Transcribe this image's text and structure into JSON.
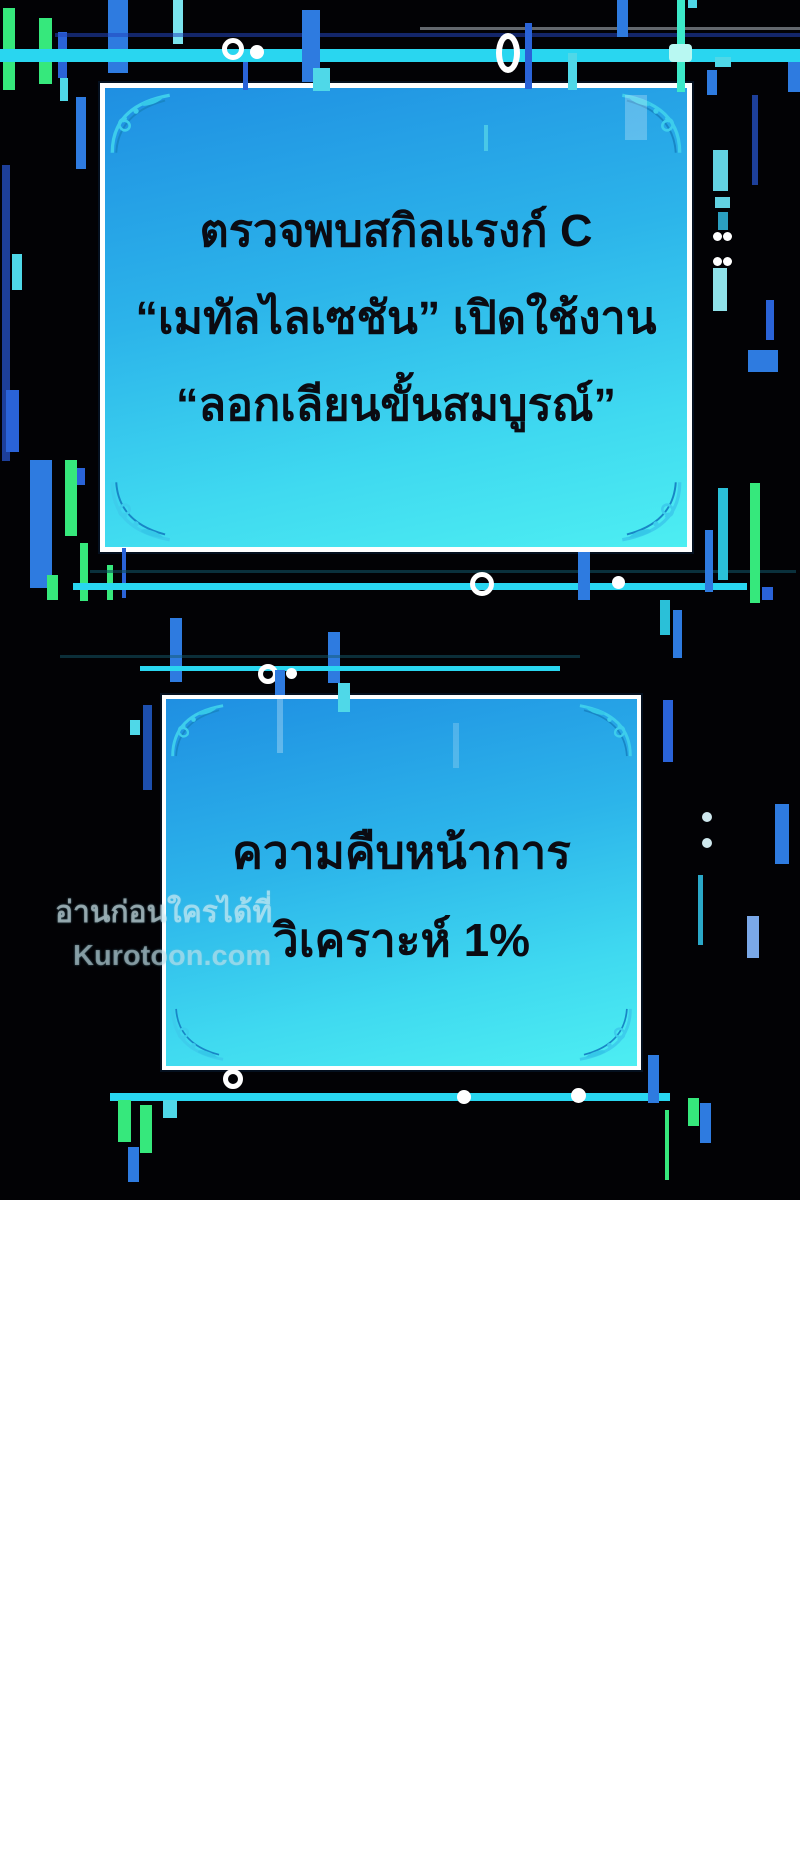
{
  "page": {
    "background_color": "#ffffff",
    "panel_background_color": "#020205"
  },
  "system_boxes": [
    {
      "lines": [
        "ตรวจพบสกิลแรงก์ C",
        "“เมทัลไลเซชัน” เปิดใช้งาน",
        "“ลอกเลียนขั้นสมบูรณ์”"
      ]
    },
    {
      "lines": [
        "ความคืบหน้าการ",
        "วิเคราะห์ 1%"
      ]
    }
  ],
  "watermark": {
    "line1": "อ่านก่อนใครได้ที่",
    "line2": "Kurotoon.com"
  },
  "colors": {
    "box_gradient_top": "#1f8fe2",
    "box_gradient_bottom": "#4deef2",
    "box_border": "#ffffff",
    "text": "#0b0b12",
    "glitch_green": "#36e87c",
    "glitch_blue": "#2e7be0",
    "glitch_dark_blue": "#2a63d8",
    "glitch_cyan": "#29d6f0",
    "glitch_pale_cyan": "#7ae4ee",
    "ornament_cyan": "#3dcdec"
  }
}
